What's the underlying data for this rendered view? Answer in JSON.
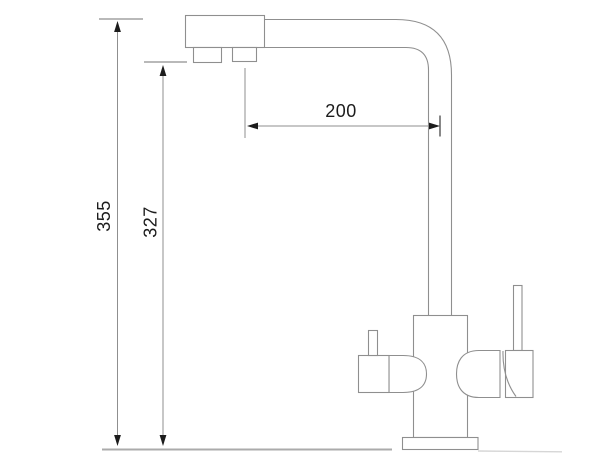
{
  "drawing": {
    "palette": {
      "bg": "#ffffff",
      "line": "#8f8f8f",
      "dim-line": "#8f8f8f",
      "ink": "#1c1c1c",
      "deck": "#ababab"
    },
    "dimensions": {
      "overall_height": "355",
      "spout_outlet_height": "327",
      "spout_reach": "200"
    }
  }
}
